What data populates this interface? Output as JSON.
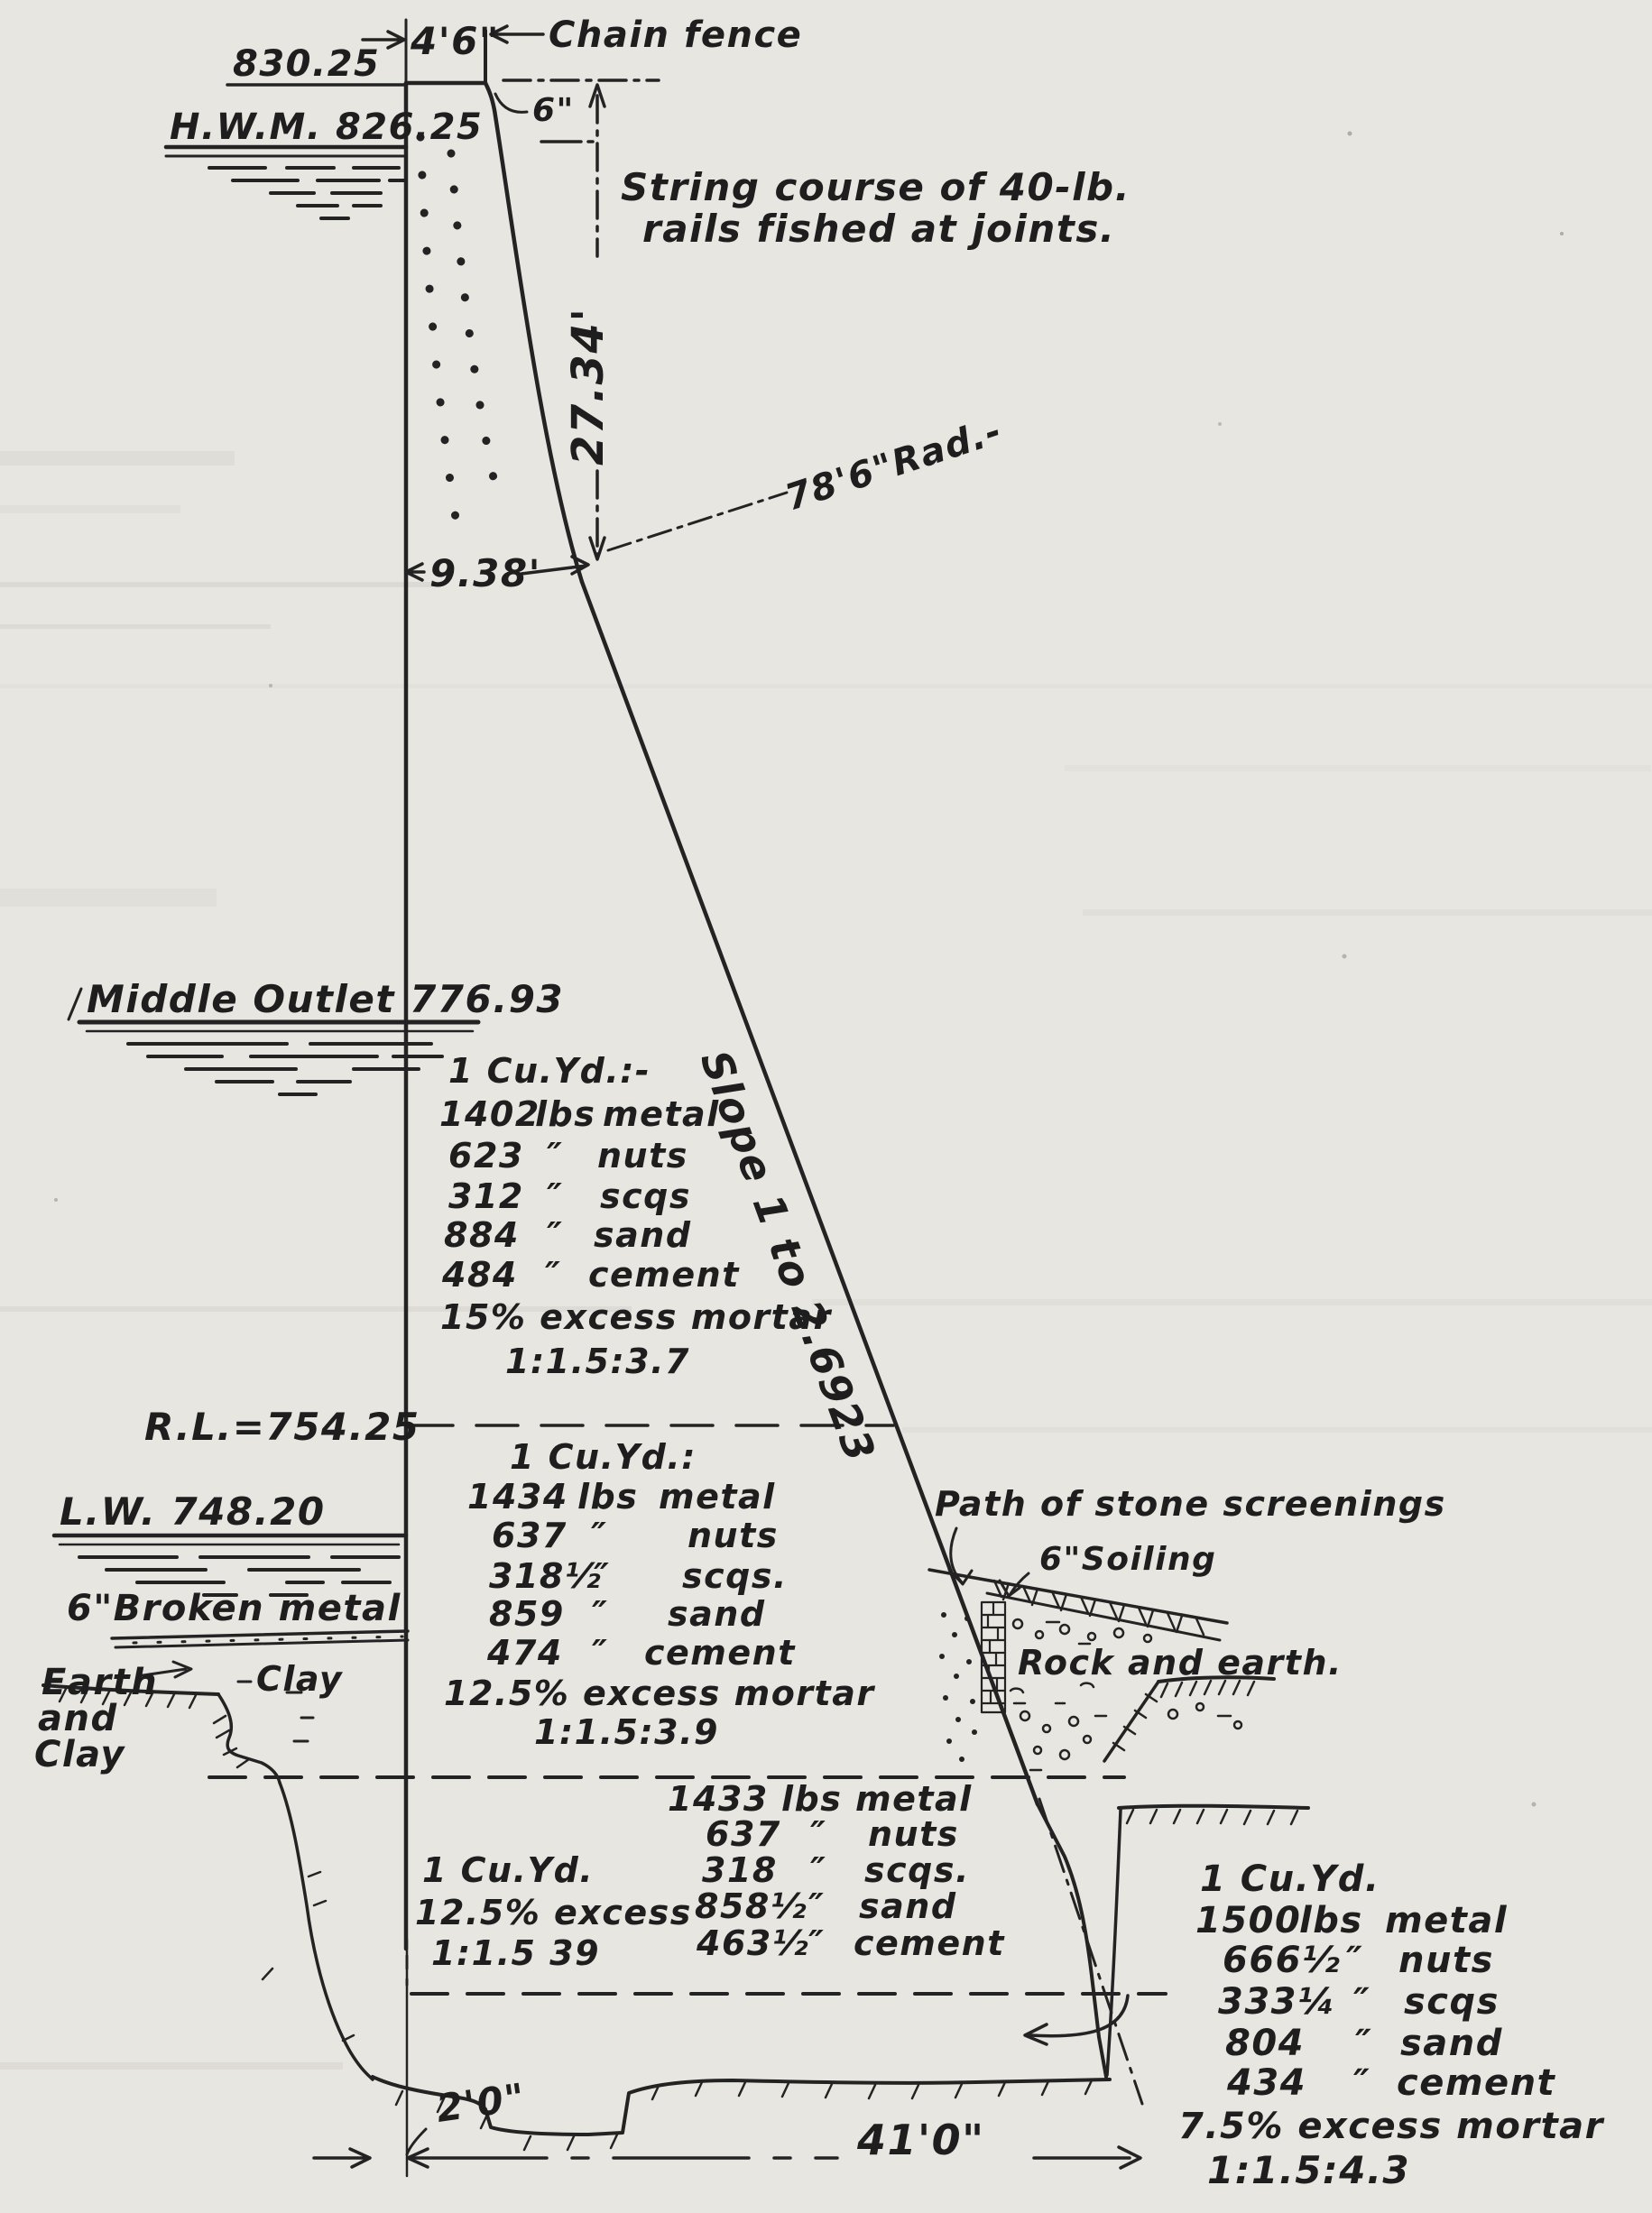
{
  "colors": {
    "paper": "#e8e6e1",
    "ink": "#232323"
  },
  "labels": {
    "elev_crest": "830.25",
    "hwm": "H.W.M. 826.25",
    "crest_width": "4'6\"",
    "chain_fence": "Chain fence",
    "six_in": "6\"",
    "string_course_1": "String course of 40-lb.",
    "string_course_2": "rails fished at joints.",
    "dim_curve_height": "27.34'",
    "radius": "78'6\"Rad.-",
    "dim_curve_offset": "9.38'",
    "middle_outlet": "Middle Outlet 776.93",
    "slope": "Slope 1 to 2.6923",
    "rl": "R.L.=754.25",
    "lw": "L.W. 748.20",
    "broken_metal": "6\"Broken metal",
    "earth_line1": "Earth",
    "earth_line2": "and",
    "earth_line3": "Clay",
    "clay": "Clay",
    "path_stone": "Path of stone screenings",
    "soiling": "6\"Soiling",
    "rock_earth": "Rock and earth.",
    "dim_base_offset": "2'0\"",
    "dim_base_width": "41'0\""
  },
  "mix1": {
    "title": "1 Cu.Yd.:-",
    "rows": [
      [
        "1402",
        "lbs",
        "metal"
      ],
      [
        "623",
        "″",
        "nuts"
      ],
      [
        "312",
        "″",
        "scqs"
      ],
      [
        "884",
        "″",
        "sand"
      ],
      [
        "484",
        "″",
        "cement"
      ]
    ],
    "excess": "15% excess mortar",
    "ratio": "1:1.5:3.7"
  },
  "mix2": {
    "title": "1 Cu.Yd.:",
    "rows": [
      [
        "1434",
        "lbs",
        "metal"
      ],
      [
        "637",
        "″",
        "nuts"
      ],
      [
        "318½",
        "″",
        "scqs."
      ],
      [
        "859",
        "″",
        "sand"
      ],
      [
        "474",
        "″",
        "cement"
      ]
    ],
    "excess": "12.5% excess mortar",
    "ratio": "1:1.5:3.9"
  },
  "mix3": {
    "rows": [
      [
        "1433",
        "lbs",
        "metal"
      ],
      [
        "637",
        "″",
        "nuts"
      ],
      [
        "318",
        "″",
        "scqs."
      ],
      [
        "858½",
        "″",
        "sand"
      ],
      [
        "463½",
        "″",
        "cement"
      ]
    ]
  },
  "mix4": {
    "title": "1 Cu.Yd.",
    "excess": "12.5% excess",
    "ratio": "1:1.5 39"
  },
  "mix5": {
    "title": "1 Cu.Yd.",
    "rows": [
      [
        "1500",
        "lbs",
        "metal"
      ],
      [
        "666½",
        "″",
        "nuts"
      ],
      [
        "333¼",
        "″",
        "scqs"
      ],
      [
        "804",
        "″",
        "sand"
      ],
      [
        "434",
        "″",
        "cement"
      ]
    ],
    "excess": "7.5% excess mortar",
    "ratio": "1:1.5:4.3"
  }
}
